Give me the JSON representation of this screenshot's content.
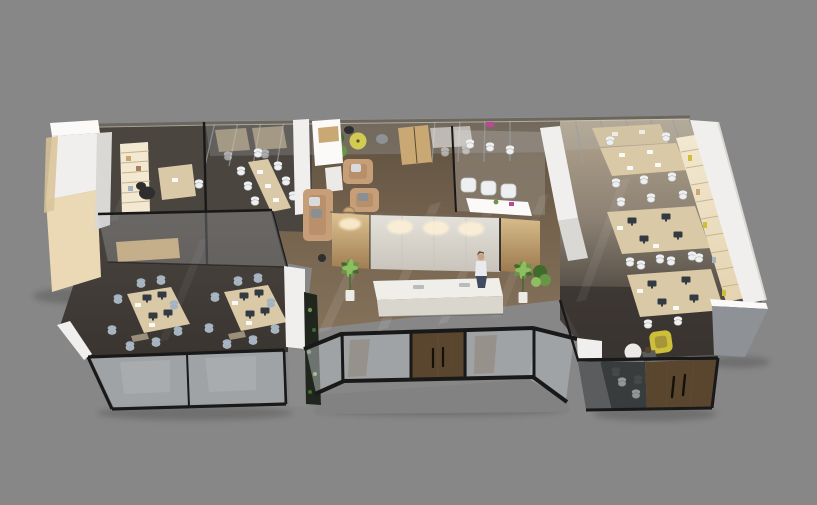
{
  "scene": {
    "type": "3d-isometric-office-floorplan-render",
    "description": "Cutaway top-down 3D render of a modern office interior on a plain gray backdrop",
    "areas": [
      {
        "name": "storage-block"
      },
      {
        "name": "executive-office"
      },
      {
        "name": "conference-room"
      },
      {
        "name": "team-meeting-room"
      },
      {
        "name": "lounge"
      },
      {
        "name": "pantry"
      },
      {
        "name": "reception"
      },
      {
        "name": "waiting-room"
      },
      {
        "name": "entrance-vestibule"
      },
      {
        "name": "open-plan-office"
      },
      {
        "name": "focus-room"
      }
    ],
    "people": [
      {
        "name": "receptionist",
        "pose": "standing-at-counter"
      },
      {
        "name": "seated-person",
        "pose": "seated-at-round-table"
      }
    ]
  },
  "colors": {
    "bg": "#878787",
    "topWallLine": "#6b675c",
    "topWallLight": "#cfcabc",
    "wallWhite": "#f0efed",
    "wallBright": "#fbfaf8",
    "wallShade": "#d9d8d4",
    "wallGray": "#8b8b8b",
    "wallDarkGray": "#5a5c5e",
    "roofGray": "#8e9296",
    "beige": "#ead9b4",
    "beigeShade": "#d9c398",
    "floorDark": "#4a453f",
    "floorDark2": "#393430",
    "floorUmberDark": "#544d45",
    "floorTaupe": "#8b8073",
    "floorBeige": "#b3a58e",
    "brown": "#75634e",
    "brownLight": "#85725b",
    "brownDeep": "#5e5040",
    "concrete": "#828282",
    "frameBlack": "#191919",
    "frameGray": "#9aa0a4",
    "glassTint": "#b9c0c4",
    "glassDark": "#2f3233",
    "woodLight": "#d9c9a6",
    "woodTan": "#c9a873",
    "woodDark": "#5e4b35",
    "woodDoor": "#5a462f",
    "woodPanelLight": "#dcc08f",
    "woodPanelDark": "#9a784d",
    "shelfLight": "#f3e9d2",
    "shelfDark": "#e3d2ae",
    "shelfLine": "#c6b28c",
    "marbleLight": "#e4e1da",
    "marbleDark": "#c8c4bb",
    "counter": "#f0eee8",
    "counterSide": "#d9d6ce",
    "glow": "#fff1d6",
    "chairWhite": "#edeff1",
    "chairWhiteShade": "#b9bcbe",
    "chairBlue": "#a3b3c2",
    "chairBlack": "#2e2e2e",
    "monitor": "#333a42",
    "paper": "#fdfdfd",
    "sofaTan": "#c69e78",
    "sofaShade": "#a87f5c",
    "pillow": "#d9dadb",
    "pillowGray": "#8a8f94",
    "plantGreen": "#679746",
    "plantDark": "#3f6b2b",
    "plantLight": "#8fbd61",
    "plantWall": "#20261d",
    "potWhite": "#eceae6",
    "accentYellow": "#cdbf3a",
    "accentMagenta": "#b84a92",
    "tableYellow": "#d2cb52",
    "skin": "#caa183",
    "hair": "#58402c",
    "shirt": "#e9eaee",
    "skirt": "#424a5e",
    "shadow": "#3a3a3a"
  }
}
